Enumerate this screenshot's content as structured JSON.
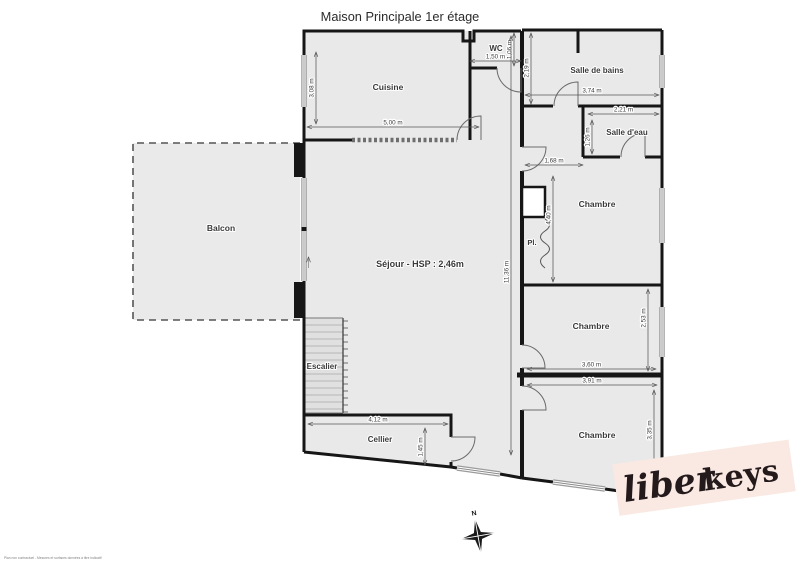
{
  "title": "Maison Principale 1er étage",
  "labels": {
    "cuisine": "Cuisine",
    "wc": "WC",
    "salle_de_bains": "Salle de bains",
    "salle_d_eau": "Salle d'eau",
    "chambre": "Chambre",
    "sejour": "Séjour - HSP : 2,46m",
    "balcon": "Balcon",
    "escalier": "Escalier",
    "cellier": "Cellier",
    "placard": "Pl."
  },
  "dimensions": {
    "cuisine_width": "5,00 m",
    "cuisine_depth": "3,08 m",
    "wc_width": "1,50 m",
    "wc_depth": "1,06 m",
    "sdb_width": "3,74 m",
    "sdb_depth": "2,19 m",
    "sde_width": "2,21 m",
    "sde_depth": "1,26 m",
    "hall_width": "1,68 m",
    "chambre_haut_depth": "4,40 m",
    "sejour_depth": "11,36 m",
    "chambre_milieu_width": "3,60 m",
    "chambre_milieu_depth": "2,53 m",
    "chambre_bas_width": "3,91 m",
    "chambre_bas_depth": "3,35 m",
    "cellier_width": "4,12 m",
    "cellier_depth": "1,45 m"
  },
  "compass": {
    "north": "N"
  },
  "logo": {
    "script": "liber",
    "bold": "keys"
  },
  "footer": {
    "disclaimer": "Plan non contractuel - Mesures et surfaces données à titre indicatif"
  },
  "colors": {
    "wall": "#161616",
    "floor": "#e9e9e9",
    "logo_bg": "#f9e9e2",
    "logo_text": "#241a1c"
  }
}
